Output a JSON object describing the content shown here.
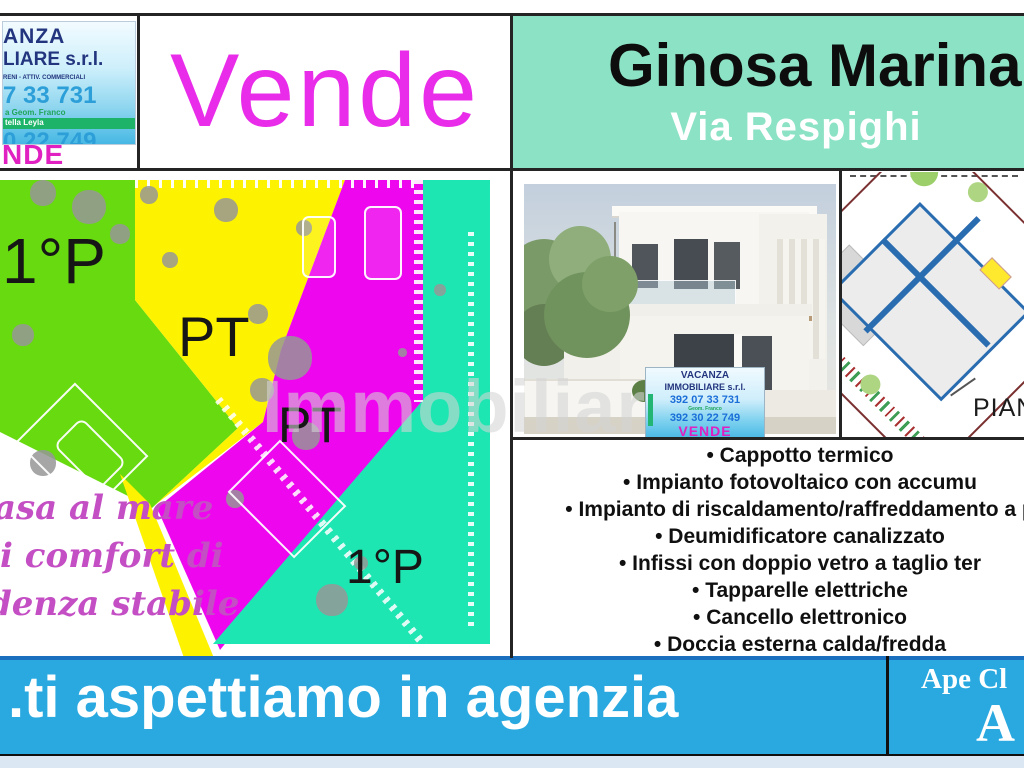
{
  "colors": {
    "mint": "#8ce2c4",
    "vende_magenta": "#e92ce9",
    "plan_green": "#68da10",
    "plan_yellow": "#fdf300",
    "plan_magenta": "#ee07ee",
    "plan_teal": "#1ee6b2",
    "band_cyan": "#29a9e0",
    "band_border": "#1a6fbe",
    "script_purple": "#c44ec4",
    "navy": "#23357e",
    "phone_blue": "#2d9fd8",
    "logo_magenta": "#e020c0",
    "bottom_strip": "#dbe7f2"
  },
  "header": {
    "agency_card": {
      "name_line1": "ANZA",
      "name_line2": "LIARE s.r.l.",
      "services_line": "RENI - ATTIV. COMMERCIALI",
      "phone1": "7 33 731",
      "agent1": "a Geom. Franco",
      "agent2": "tella Leyla",
      "phone2": "0 22 749",
      "vende_fragment": "NDE"
    },
    "vende_label": "Vende",
    "location_title": "Ginosa Marina",
    "location_subtitle": "Via Respighi"
  },
  "site_plan": {
    "labels": {
      "green": "1°P",
      "yellow": "PT",
      "magenta": "PT",
      "teal": "1°P"
    },
    "caption_lines": [
      "asa al mare",
      "i comfort di",
      "denza stabile"
    ]
  },
  "watermark": "Immobiliare.it",
  "photo_card": {
    "name_line1": "VACANZA",
    "name_line2": "IMMOBILIARE s.r.l.",
    "phone1": "392 07 33 731",
    "agent": "Geom. Franco",
    "phone2": "392 30 22 749",
    "vende": "VENDE"
  },
  "detail_plan": {
    "label": "PIAN"
  },
  "features": [
    "Cappotto termico",
    "Impianto fotovoltaico con accumu",
    "Impianto di riscaldamento/raffreddamento a p",
    "Deumidificatore canalizzato",
    "Infissi con doppio vetro a taglio ter",
    "Tapparelle elettriche",
    "Cancello elettronico",
    "Doccia esterna calda/fredda"
  ],
  "footer": {
    "message": ".ti aspettiamo in agenzia",
    "ape_label": "Ape Cl",
    "ape_class": "A"
  }
}
